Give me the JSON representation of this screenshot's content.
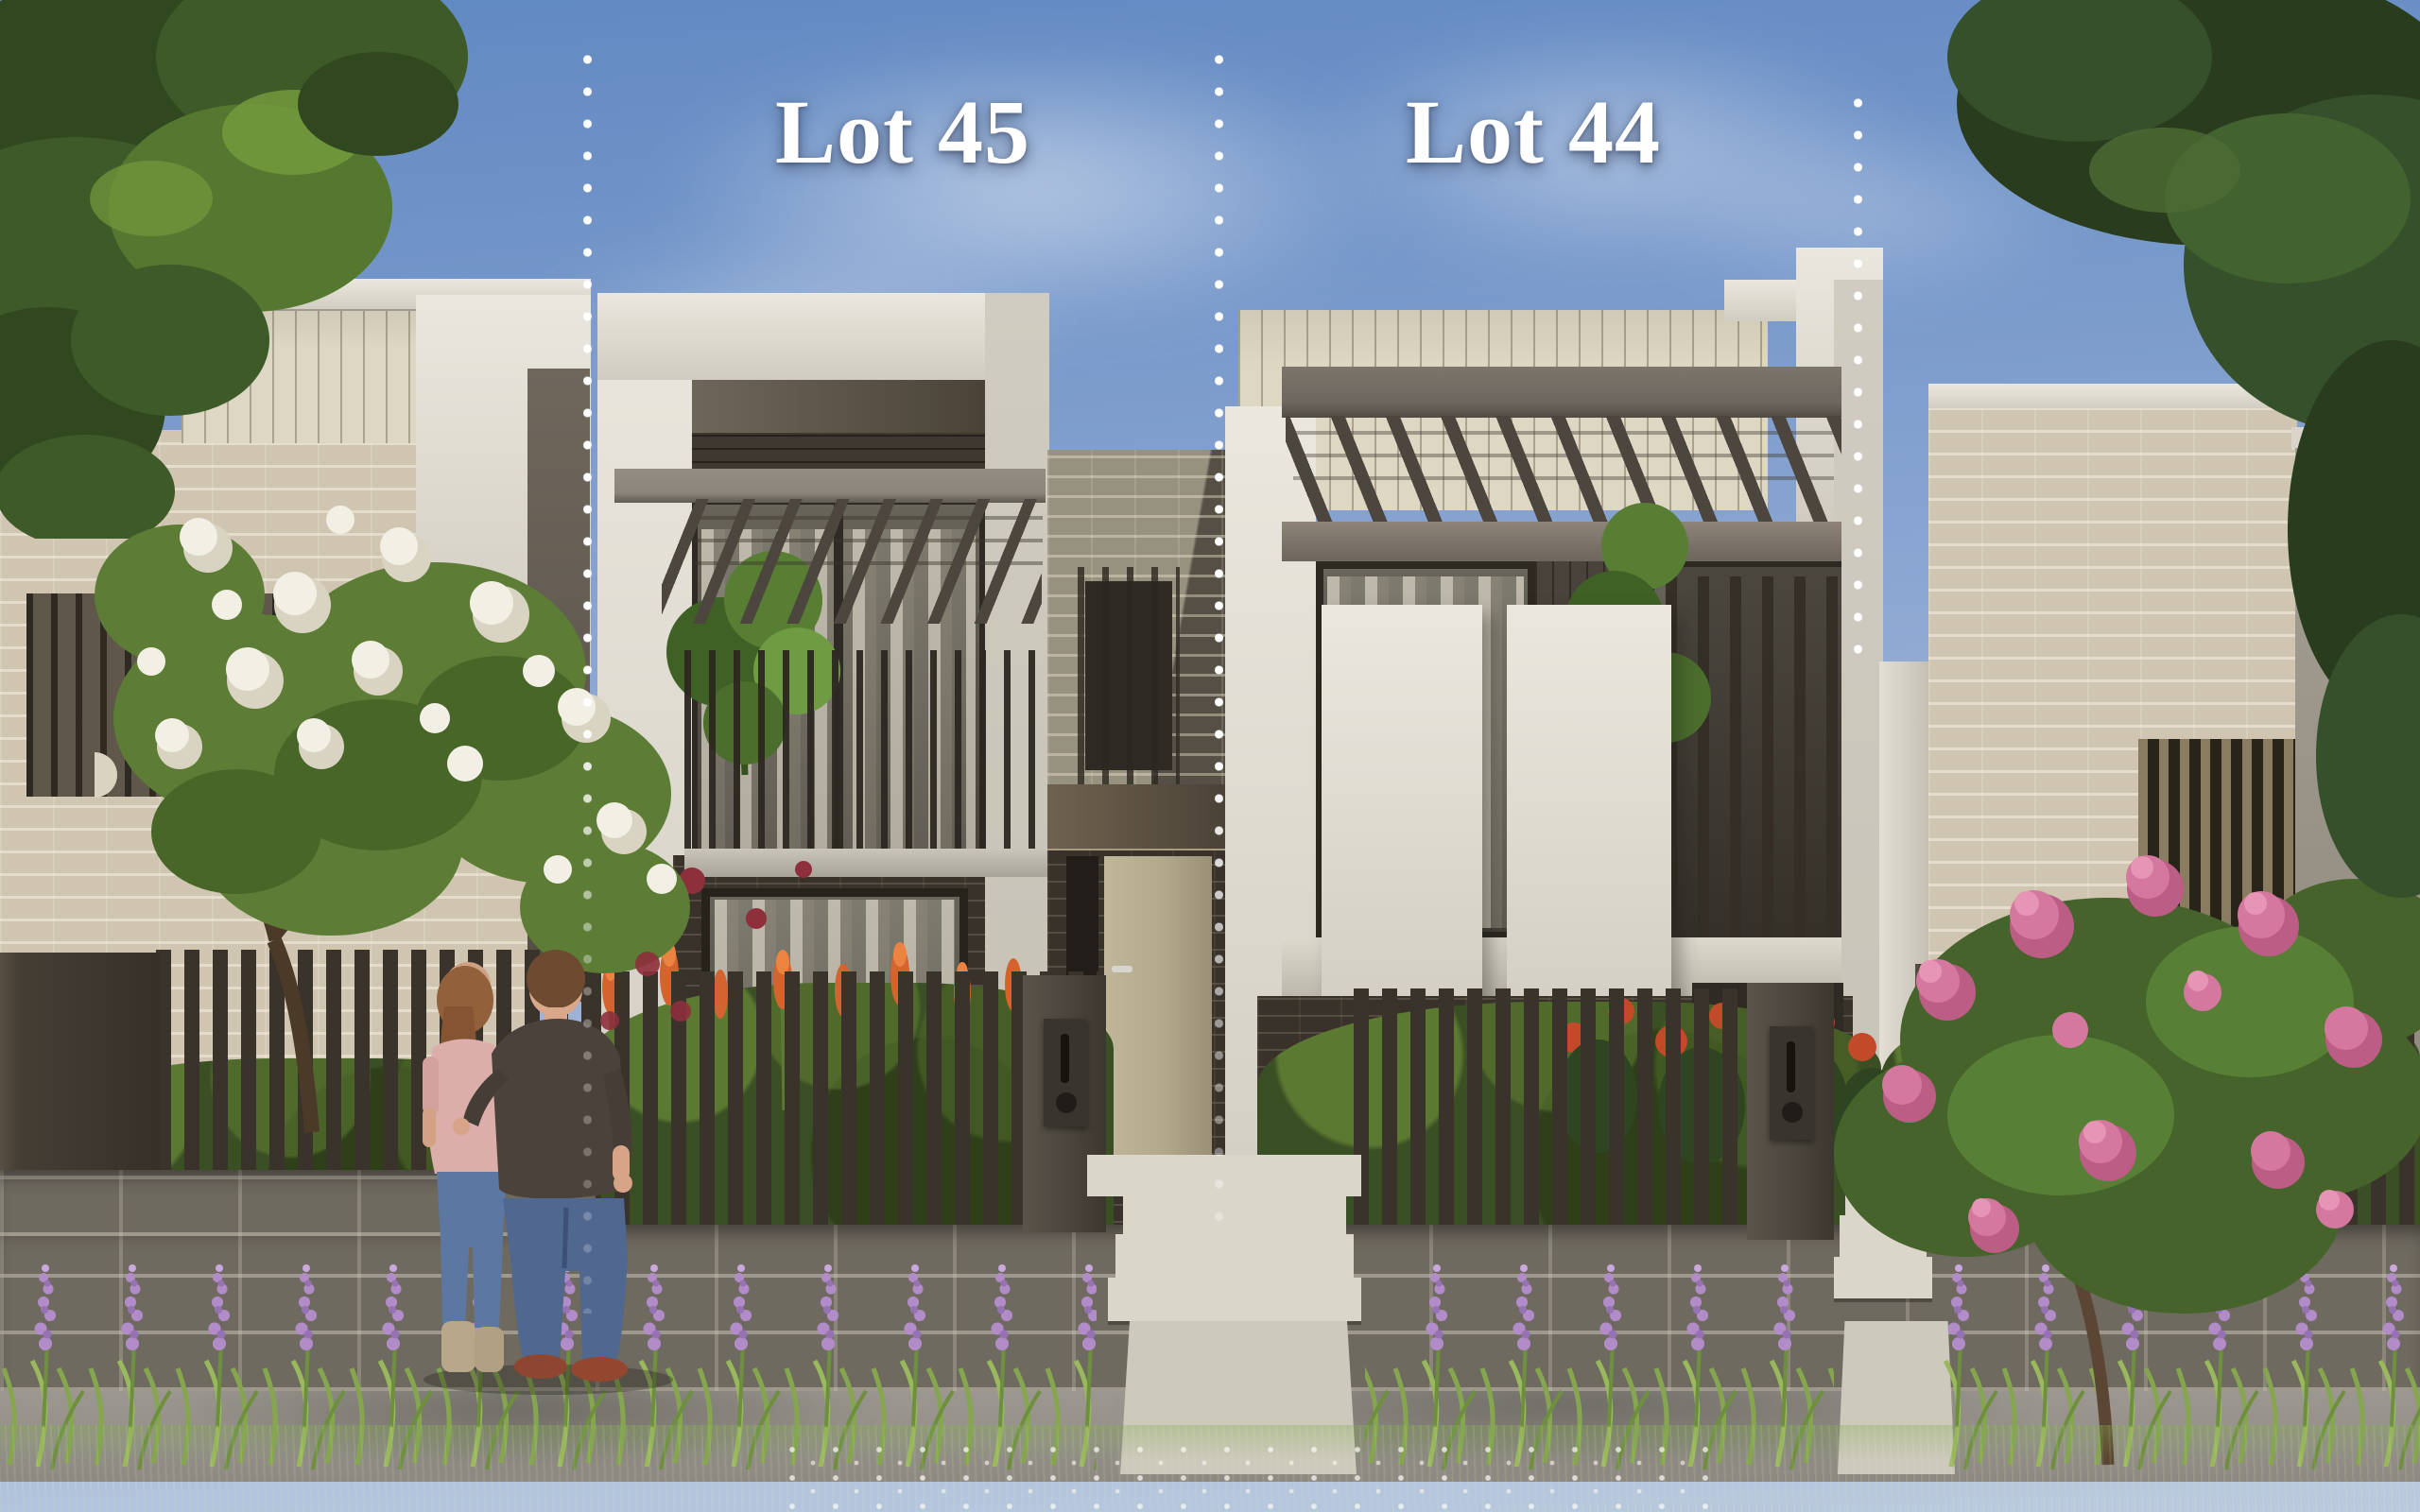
{
  "annotations": {
    "lot_labels": [
      {
        "id": "lot-45",
        "label": "Lot 45"
      },
      {
        "id": "lot-44",
        "label": "Lot 44"
      }
    ],
    "label_color": "#ffffff",
    "boundary_marker_color": "#ffffff",
    "boundary_lines": 3
  },
  "palette": {
    "sky-top": "#6088c2",
    "sky-mid": "#8fa9d3",
    "sky-low": "#bac9df",
    "cloud": "#ffffff",
    "render-hi": "#eae7de",
    "render-lo": "#d0ccc1",
    "render-shade": "#c6c2b6",
    "cream-clad": "#ddd7c3",
    "clad-line": "#b5ad94",
    "soffit-a": "#6e665a",
    "soffit-b": "#4a4338",
    "beam": "#8b857c",
    "beam-dark": "#6e6760",
    "rafter": "#4c463e",
    "glass-hi": "#67655a",
    "glass-lo": "#44423a",
    "curtain": "#d8d1c2",
    "dark-clad": "#49433b",
    "baluster": "#2f2a23",
    "brick-light": "#97917f",
    "brick-shadow": "#564f45",
    "brick-mortar": "#e4ddc9",
    "dark-brick": "#38322b",
    "cream-brick": "#cfc5b1",
    "cream-brick-line": "#ece5d4",
    "door": "#b2a88c",
    "door-frame": "#1f1d19",
    "awning-a": "#6f624f",
    "awning-b": "#4a4136",
    "porch": "#a89a80",
    "letterbox": "#4f4a41",
    "plate": "#39342d",
    "fence": "#3a332b",
    "gate": "#453e35",
    "stone": "#6f6a60",
    "stone-line": "#c8c3b2",
    "walk-a": "#a6a29b",
    "walk-b": "#8e8a83",
    "path": "#cdc9bd",
    "step": "#dad6ca",
    "grass-a": "#5a7d3b",
    "grass-b": "#34501e",
    "bush": "#3b4f24",
    "bush-hi": "#5b7a33",
    "lavender": "#b18cc9",
    "lavender-deep": "#9672b2",
    "leaf-strap": "#85a64f",
    "orange": "#d4632f",
    "orange-hi": "#ea8440",
    "crimson": "#8e2f3c",
    "jasmine": "#f6f4ec",
    "tl1": "#31471f",
    "tl2": "#3e5a28",
    "tl3": "#55772f",
    "tl4": "#739a3c",
    "tr1": "#293c1d",
    "tr2": "#35502a",
    "tr3": "#42622f",
    "wt-leaf": "#5d7d36",
    "blossom": "#f2efe4",
    "blossom-sh": "#d9d4c2",
    "pink1": "#d4789f",
    "pink2": "#bb5d85",
    "pink3": "#e795b5",
    "pink-leaf": "#45632b",
    "trunk": "#4c3a28",
    "skin": "#d9a88a",
    "hair-m": "#6e4a30",
    "hair-w": "#92603a",
    "shirt": "#4b433b",
    "jeans-m": "#50688f",
    "jeans-w": "#5d77a3",
    "shoe": "#94462f",
    "top-w": "#dcaeaa",
    "boot": "#b9a78a"
  }
}
